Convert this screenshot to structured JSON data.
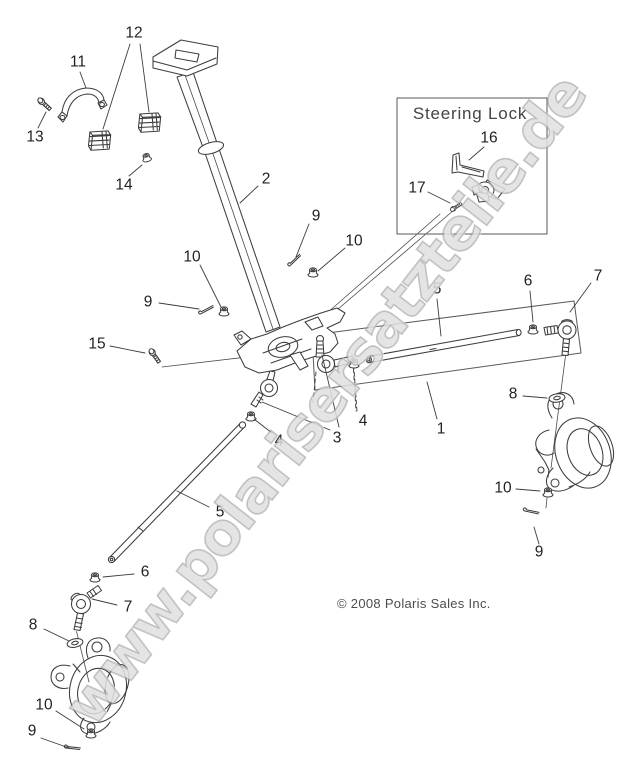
{
  "page": {
    "width": 625,
    "height": 768,
    "background": "#ffffff"
  },
  "watermark": {
    "text": "www.polarisersatzteile.de"
  },
  "copyright": {
    "text": "© 2008 Polaris Sales Inc."
  },
  "inset": {
    "title": "Steering Lock"
  },
  "colors": {
    "line": "#3d3d3d",
    "label": "#222222",
    "copyright": "#4d4d4d",
    "watermark_fill": "#cecece",
    "watermark_stroke": "#8a8a8a",
    "inset_border": "#5a5a5a",
    "background": "#ffffff"
  },
  "diagram": {
    "type": "exploded-parts-diagram",
    "callouts": [
      {
        "label": "13",
        "x": 35,
        "y": 137,
        "leaders": [
          [
            38,
            128,
            46,
            112
          ]
        ]
      },
      {
        "label": "11",
        "x": 78,
        "y": 62,
        "leaders": [
          [
            80,
            72,
            86,
            88
          ]
        ]
      },
      {
        "label": "12",
        "x": 134,
        "y": 33,
        "leaders": [
          [
            130,
            44,
            103,
            129
          ],
          [
            140,
            44,
            149,
            112
          ]
        ]
      },
      {
        "label": "14",
        "x": 124,
        "y": 185,
        "leaders": [
          [
            129,
            176,
            142,
            165
          ]
        ]
      },
      {
        "label": "2",
        "x": 266,
        "y": 179,
        "leaders": [
          [
            258,
            186,
            240,
            203
          ]
        ]
      },
      {
        "label": "9",
        "x": 316,
        "y": 216,
        "leaders": [
          [
            309,
            224,
            296,
            257
          ]
        ]
      },
      {
        "label": "10",
        "x": 354,
        "y": 241,
        "leaders": [
          [
            345,
            248,
            318,
            271
          ]
        ]
      },
      {
        "label": "10",
        "x": 192,
        "y": 257,
        "leaders": [
          [
            200,
            265,
            221,
            307
          ]
        ]
      },
      {
        "label": "9",
        "x": 148,
        "y": 302,
        "leaders": [
          [
            159,
            303,
            199,
            309
          ]
        ]
      },
      {
        "label": "15",
        "x": 97,
        "y": 344,
        "leaders": [
          [
            110,
            346,
            145,
            353
          ]
        ]
      },
      {
        "label": "16",
        "x": 489,
        "y": 138,
        "leaders": [
          [
            484,
            147,
            469,
            160
          ]
        ]
      },
      {
        "label": "17",
        "x": 417,
        "y": 188,
        "leaders": [
          [
            428,
            192,
            450,
            203
          ]
        ]
      },
      {
        "label": "5",
        "x": 437,
        "y": 289,
        "leaders": [
          [
            437,
            299,
            441,
            336
          ]
        ]
      },
      {
        "label": "6",
        "x": 528,
        "y": 281,
        "leaders": [
          [
            530,
            291,
            533,
            322
          ]
        ]
      },
      {
        "label": "7",
        "x": 598,
        "y": 276,
        "leaders": [
          [
            591,
            283,
            570,
            312
          ]
        ]
      },
      {
        "label": "8",
        "x": 513,
        "y": 394,
        "leaders": [
          [
            523,
            396,
            547,
            398
          ]
        ]
      },
      {
        "label": "1",
        "x": 441,
        "y": 429,
        "leaders": [
          [
            437,
            419,
            427,
            382
          ]
        ]
      },
      {
        "label": "4",
        "x": 363,
        "y": 421,
        "dashed": true,
        "leaders": [
          [
            357,
            411,
            354,
            369
          ]
        ]
      },
      {
        "label": "3",
        "x": 337,
        "y": 438,
        "leaders": [
          [
            330,
            430,
            262,
            402
          ],
          [
            339,
            427,
            322,
            355
          ]
        ]
      },
      {
        "label": "4",
        "x": 279,
        "y": 441,
        "leaders": [
          [
            272,
            433,
            254,
            419
          ]
        ]
      },
      {
        "label": "5",
        "x": 220,
        "y": 512,
        "leaders": [
          [
            209,
            507,
            177,
            491
          ]
        ]
      },
      {
        "label": "6",
        "x": 145,
        "y": 572,
        "leaders": [
          [
            134,
            574,
            103,
            577
          ]
        ]
      },
      {
        "label": "7",
        "x": 128,
        "y": 607,
        "leaders": [
          [
            117,
            605,
            92,
            599
          ]
        ]
      },
      {
        "label": "8",
        "x": 33,
        "y": 625,
        "leaders": [
          [
            44,
            629,
            69,
            641
          ]
        ]
      },
      {
        "label": "10",
        "x": 44,
        "y": 705,
        "leaders": [
          [
            56,
            711,
            84,
            729
          ]
        ]
      },
      {
        "label": "9",
        "x": 32,
        "y": 731,
        "leaders": [
          [
            41,
            738,
            69,
            748
          ]
        ]
      },
      {
        "label": "10",
        "x": 503,
        "y": 488,
        "leaders": [
          [
            516,
            489,
            540,
            491
          ]
        ]
      },
      {
        "label": "9",
        "x": 539,
        "y": 552,
        "leaders": [
          [
            539,
            544,
            534,
            527
          ]
        ]
      }
    ]
  }
}
